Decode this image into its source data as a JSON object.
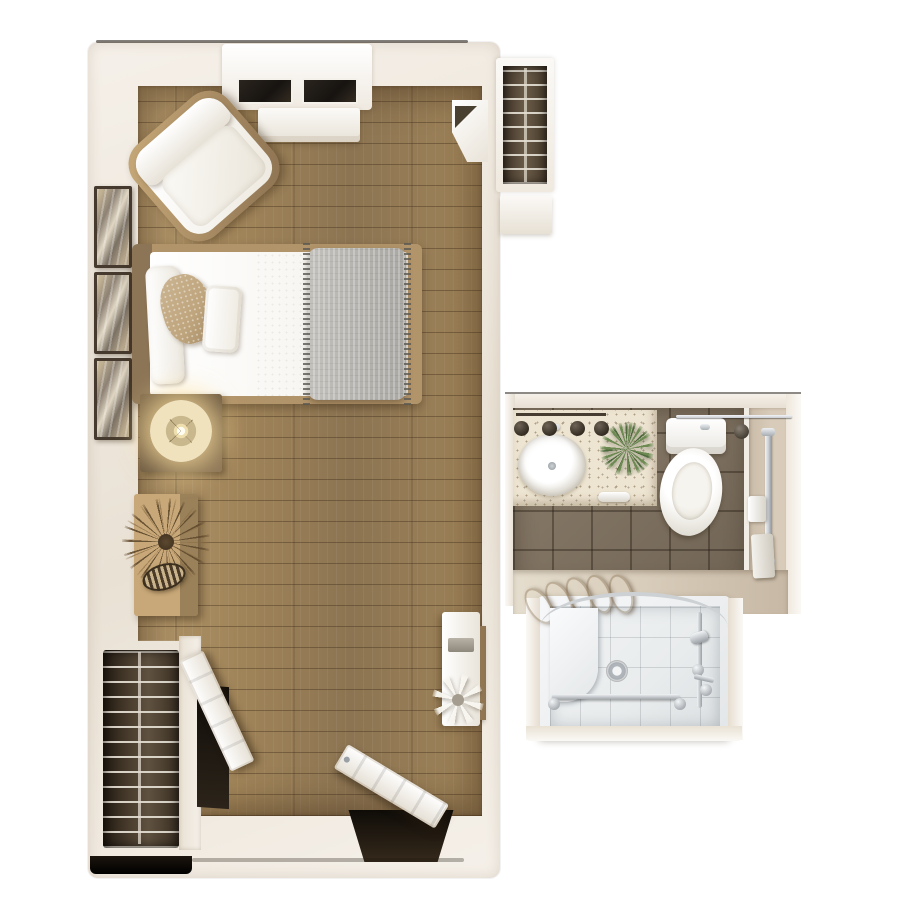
{
  "floor_plan": {
    "type": "studio-apartment-top-down-3d-render",
    "rooms": [
      {
        "name": "bedroom-living-area",
        "floor": "wood-plank",
        "furniture": [
          "window-bay",
          "window-console",
          "armchair",
          "bed",
          "gray-blanket",
          "pillows",
          "wall-art-frames",
          "nightstand",
          "table-lamp",
          "dresser",
          "dried-palm-plant",
          "basket",
          "corner-cabinet",
          "desk-console",
          "desk-chair",
          "white-flowers",
          "wardrobe-closet-wire-shelves",
          "closet-door-open",
          "entry-door-open"
        ]
      },
      {
        "name": "bathroom",
        "floor": "taupe-ceramic-tile",
        "fixtures": [
          "vanity-counter",
          "oval-sink",
          "faucet",
          "vanity-light-fixtures",
          "potted-green-plant",
          "hand-towel",
          "toilet",
          "towel-bar",
          "vertical-grab-bar",
          "toilet-paper-holder",
          "wall-dispenser",
          "toilet-brush",
          "rolled-towels",
          "walk-in-shower",
          "shower-bench",
          "shower-drain",
          "shower-grab-bar",
          "curtain-rod",
          "shower-slide-bar",
          "shower-head",
          "shower-controls"
        ]
      },
      {
        "name": "hall-closet",
        "floor": "none",
        "fixtures": [
          "wire-shelves",
          "closet-pole"
        ]
      }
    ],
    "counts": {
      "wall_art_frames": 3,
      "rolled_towels": 5,
      "vanity_lights": 4,
      "window_panes": 2
    }
  },
  "palette": {
    "bg": "#ffffff",
    "wall_face": "#f5f0e9",
    "wall_face2": "#e9e1d4",
    "wood_a": "#a08459",
    "wood_b": "#8c7452",
    "wood_c": "#b2966a",
    "wood_seam": "rgba(58,40,22,0.38)",
    "shelf_wire": "#d9d2c6",
    "bed_white": "#f8f6f2",
    "bed_wood": "#b2946a",
    "bed_head": "#8c7556",
    "blanket": "#b8b6b1",
    "pillow_tan": "#bfa57d",
    "wood_furn": "#c8aa79",
    "dresser": "#c8a878",
    "lamp_cream": "#f0e2bd",
    "tile_a": "#8b7d6b",
    "tile_b": "#6f6354",
    "grout": "rgba(38,30,20,0.40)",
    "counter": "#ede4d1",
    "beige": "#d8cbb9",
    "beige2": "#c6b8a4",
    "chrome": "#c9cdd1",
    "towel_a": "#c4a57a",
    "towel_b": "#a0withdraw",
    "towel_b2": "#a08a5f",
    "green_a": "#6c8a52",
    "green_b": "#4f6b3d",
    "shower_tile": "#e9eced",
    "shower_grout": "rgba(70,80,90,0.18)"
  }
}
